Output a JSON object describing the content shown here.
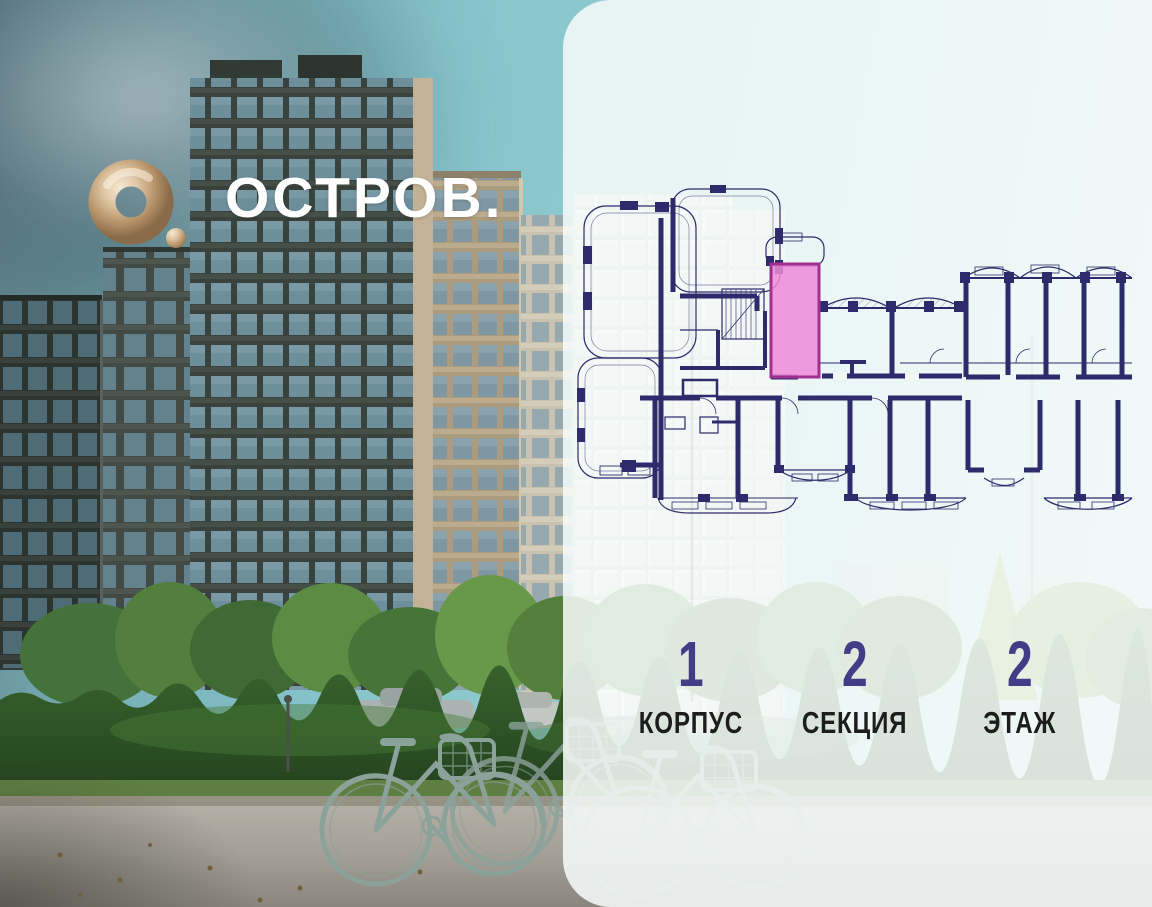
{
  "brand": {
    "wordmark": "ОСТРОВ.",
    "logo_icon": "gold-ring-with-dot-icon"
  },
  "panel": {
    "stats": [
      {
        "value": "1",
        "label": "КОРПУС"
      },
      {
        "value": "2",
        "label": "СЕКЦИЯ"
      },
      {
        "value": "2",
        "label": "ЭТАЖ"
      }
    ]
  },
  "floor_plan": {
    "type": "apartment-floor-plan",
    "highlighted_unit_color": "#ef8ad9",
    "wall_color": "#2d2b6b"
  },
  "colors": {
    "stat_number_indigo": "#433c86",
    "label_black": "#1d1d1d",
    "logo_gold": "#d9bf9e",
    "panel_background": "rgba(247,251,250,0.86)",
    "sky_teal": "#86c3ca"
  }
}
